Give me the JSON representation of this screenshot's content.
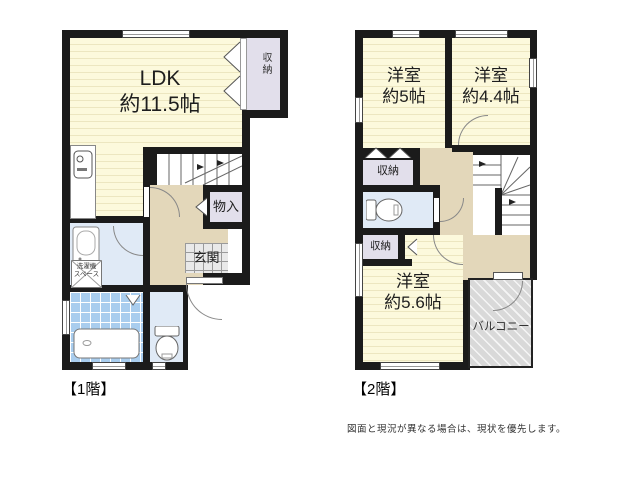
{
  "floor1": {
    "caption": "【1階】",
    "ldk": {
      "name": "LDK",
      "size": "約11.5帖"
    },
    "closet": "収納",
    "storage": "物入",
    "entrance": "玄関",
    "laundry": [
      "洗濯機",
      "スペース"
    ]
  },
  "floor2": {
    "caption": "【2階】",
    "bedroom1": {
      "name": "洋室",
      "size": "約5帖"
    },
    "bedroom2": {
      "name": "洋室",
      "size": "約4.4帖"
    },
    "bedroom3": {
      "name": "洋室",
      "size": "約5.6帖"
    },
    "closet_a": "収納",
    "closet_b": "収納",
    "balcony": "バルコニー"
  },
  "disclaimer": "図面と現況が異なる場合は、現状を優先します。",
  "colors": {
    "wall": "#1b1b1b",
    "room_yellow": "#fcf9dc",
    "closet_lavender": "#e2dfeb",
    "hall_tan": "#e3d7ba",
    "wet_blue": "#e0eaf6",
    "bath_tile_blue": "#a9cdee",
    "balcony_gray": "#d9d9d9"
  }
}
